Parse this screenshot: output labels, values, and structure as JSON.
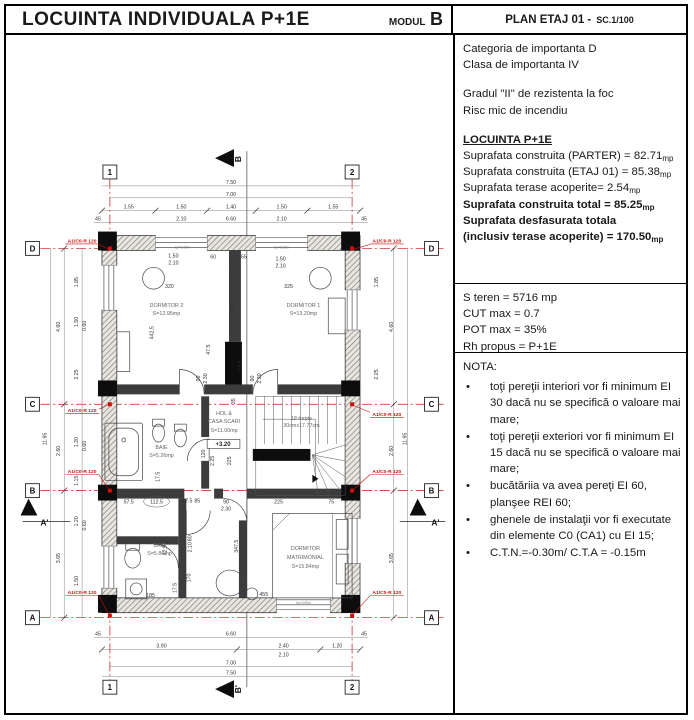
{
  "header": {
    "title": "LOCUINTA INDIVIDUALA P+1E",
    "modul_label": "MODUL",
    "modul_value": "B",
    "plan_label": "PLAN ETAJ 01 -",
    "scale": "SC.1/100"
  },
  "info_panel": {
    "importance": [
      "Categoria  de importanta  D",
      "Clasa de importanta IV"
    ],
    "fire": [
      "Gradul \"II\" de rezistenta la foc",
      "Risc mic de incendiu"
    ],
    "areas_title": "LOCUINTA P+1E",
    "areas": [
      {
        "text": "Suprafata construita (PARTER) = 82.71",
        "unit": "mp"
      },
      {
        "text": "Suprafata construita (ETAJ 01) = 85.38",
        "unit": "mp"
      },
      {
        "text": "Suprafata terase acoperite= 2.54",
        "unit": "mp"
      },
      {
        "text": "Suprafata construita total = 85.25",
        "unit": "mp"
      },
      {
        "text": "Suprafata desfasurata totala",
        "unit": ""
      },
      {
        "text": "(inclusiv terase acoperite) = 170.50",
        "unit": "mp"
      }
    ],
    "urbanism": [
      "S teren = 5716 mp",
      "CUT max = 0.7",
      "POT max = 35%",
      "Rh propus = P+1E"
    ],
    "nota_title": "NOTA:",
    "nota": [
      {
        "dot": "•",
        "text": "toţi pereţii interiori vor fi minimum EI 30 dacă nu se specifică o valoare mai mare;"
      },
      {
        "dot": "•",
        "text": "toţi pereţii exteriori vor fi minimum EI 15 dacă nu se specifică o valoare mai mare;"
      },
      {
        "dot": "•",
        "text": "bucătăriia va avea pereţi EI 60, planşee REI 60;"
      },
      {
        "dot": "•",
        "text": "ghenele de instalaţii vor fi executate din elemente C0 (CA1) cu EI 15;"
      },
      {
        "dot": "•",
        "text": "C.T.N.=-0.30m/ C.T.A = -0.15m"
      }
    ]
  },
  "colors": {
    "accent_red": "#cc1111",
    "line_black": "#000000"
  },
  "plan": {
    "grid_bubbles": [
      {
        "t": "1",
        "x": 108,
        "y": 171
      },
      {
        "t": "2",
        "x": 352,
        "y": 171
      },
      {
        "t": "1",
        "x": 108,
        "y": 690
      },
      {
        "t": "2",
        "x": 352,
        "y": 690
      },
      {
        "t": "D",
        "x": 30,
        "y": 248
      },
      {
        "t": "C",
        "x": 30,
        "y": 405
      },
      {
        "t": "B",
        "x": 30,
        "y": 492
      },
      {
        "t": "A",
        "x": 30,
        "y": 620
      },
      {
        "t": "D",
        "x": 432,
        "y": 248
      },
      {
        "t": "C",
        "x": 432,
        "y": 405
      },
      {
        "t": "B",
        "x": 432,
        "y": 492
      },
      {
        "t": "A",
        "x": 432,
        "y": 620
      }
    ],
    "texts": [
      {
        "t": "7.50",
        "x": 230,
        "y": 183
      },
      {
        "t": "7.00",
        "x": 230,
        "y": 195
      },
      {
        "t": "1.55",
        "x": 127,
        "y": 208
      },
      {
        "t": "1.50",
        "x": 180,
        "y": 208
      },
      {
        "t": "1.40",
        "x": 230,
        "y": 208
      },
      {
        "t": "1.50",
        "x": 281,
        "y": 208
      },
      {
        "t": "1.55",
        "x": 333,
        "y": 208
      },
      {
        "t": "45",
        "x": 96,
        "y": 220
      },
      {
        "t": "2.10",
        "x": 180,
        "y": 220
      },
      {
        "t": "6.60",
        "x": 230,
        "y": 220
      },
      {
        "t": "2.10",
        "x": 281,
        "y": 220
      },
      {
        "t": "45",
        "x": 364,
        "y": 220
      },
      {
        "t": "45",
        "x": 96,
        "y": 638
      },
      {
        "t": "6.60",
        "x": 230,
        "y": 638
      },
      {
        "t": "45",
        "x": 364,
        "y": 638
      },
      {
        "t": "3.90",
        "x": 160,
        "y": 650
      },
      {
        "t": "2.40",
        "x": 283,
        "y": 650
      },
      {
        "t": "1.20",
        "x": 337,
        "y": 650
      },
      {
        "t": "2.10",
        "x": 283,
        "y": 659
      },
      {
        "t": "7.00",
        "x": 230,
        "y": 667
      },
      {
        "t": "7.50",
        "x": 230,
        "y": 677
      },
      {
        "t": "11.65",
        "x": 44,
        "y": 440,
        "r": -90
      },
      {
        "t": "4.60",
        "x": 58,
        "y": 327,
        "r": -90
      },
      {
        "t": "2.60",
        "x": 58,
        "y": 452,
        "r": -90
      },
      {
        "t": "3.65",
        "x": 58,
        "y": 560,
        "r": -90
      },
      {
        "t": "1.85",
        "x": 76,
        "y": 282,
        "r": -90
      },
      {
        "t": "1.50",
        "x": 76,
        "y": 322,
        "r": -90
      },
      {
        "t": "0.60",
        "x": 84,
        "y": 326,
        "r": -90
      },
      {
        "t": "2.25",
        "x": 76,
        "y": 375,
        "r": -90
      },
      {
        "t": "1.20",
        "x": 76,
        "y": 443,
        "r": -90
      },
      {
        "t": "0.60",
        "x": 84,
        "y": 447,
        "r": -90
      },
      {
        "t": "1.15",
        "x": 76,
        "y": 482,
        "r": -90
      },
      {
        "t": "1.20",
        "x": 76,
        "y": 523,
        "r": -90
      },
      {
        "t": "0.60",
        "x": 84,
        "y": 527,
        "r": -90
      },
      {
        "t": "1.50",
        "x": 76,
        "y": 583,
        "r": -90
      },
      {
        "t": "4.60",
        "x": 393,
        "y": 327,
        "r": -90
      },
      {
        "t": "11.65",
        "x": 407,
        "y": 440,
        "r": -90
      },
      {
        "t": "1.85",
        "x": 378,
        "y": 282,
        "r": -90
      },
      {
        "t": "2.25",
        "x": 378,
        "y": 375,
        "r": -90
      },
      {
        "t": "2.60",
        "x": 393,
        "y": 452,
        "r": -90
      },
      {
        "t": "3.65",
        "x": 393,
        "y": 560,
        "r": -90
      },
      {
        "t": "1.50",
        "x": 172,
        "y": 257
      },
      {
        "t": "2.10",
        "x": 172,
        "y": 264
      },
      {
        "t": "60",
        "x": 212,
        "y": 258
      },
      {
        "t": "65",
        "x": 243,
        "y": 258
      },
      {
        "t": "1.50",
        "x": 280,
        "y": 260
      },
      {
        "t": "2.10",
        "x": 280,
        "y": 267
      },
      {
        "t": "15",
        "x": 233,
        "y": 272,
        "r": -90
      },
      {
        "t": "320",
        "x": 168,
        "y": 288
      },
      {
        "t": "325",
        "x": 288,
        "y": 288
      },
      {
        "t": "300",
        "x": 233,
        "y": 308,
        "r": -90
      },
      {
        "t": "442.5",
        "x": 152,
        "y": 333,
        "r": -90
      },
      {
        "t": "47.5",
        "x": 209,
        "y": 350,
        "r": -90
      },
      {
        "t": "17.5",
        "x": 241,
        "y": 366,
        "r": -90
      },
      {
        "t": "90",
        "x": 199,
        "y": 379,
        "r": -90
      },
      {
        "t": "2.30",
        "x": 206,
        "y": 379,
        "r": -90
      },
      {
        "t": "90",
        "x": 253,
        "y": 379,
        "r": -90
      },
      {
        "t": "2.30",
        "x": 260,
        "y": 379,
        "r": -90
      },
      {
        "t": "35",
        "x": 234,
        "y": 402,
        "r": -90
      },
      {
        "t": "120",
        "x": 204,
        "y": 455,
        "r": -90
      },
      {
        "t": "2.25",
        "x": 213,
        "y": 462,
        "r": -90
      },
      {
        "t": "225",
        "x": 230,
        "y": 462,
        "r": -90
      },
      {
        "t": "17.5",
        "x": 158,
        "y": 478,
        "r": -90
      },
      {
        "t": "57.5",
        "x": 127,
        "y": 505
      },
      {
        "t": "112.5",
        "x": 155,
        "y": 505
      },
      {
        "t": "17.5",
        "x": 186,
        "y": 504
      },
      {
        "t": "85",
        "x": 196,
        "y": 504
      },
      {
        "t": "90",
        "x": 225,
        "y": 505
      },
      {
        "t": "2.30",
        "x": 225,
        "y": 512
      },
      {
        "t": "225",
        "x": 278,
        "y": 505
      },
      {
        "t": "75",
        "x": 331,
        "y": 505
      },
      {
        "t": "80",
        "x": 190,
        "y": 540,
        "r": -90
      },
      {
        "t": "2.10",
        "x": 190,
        "y": 549,
        "r": -90
      },
      {
        "t": "347.5",
        "x": 237,
        "y": 548,
        "r": -90
      },
      {
        "t": "42.5",
        "x": 165,
        "y": 552,
        "r": -90
      },
      {
        "t": "170",
        "x": 189,
        "y": 580,
        "r": -90
      },
      {
        "t": "455",
        "x": 263,
        "y": 598
      },
      {
        "t": "185",
        "x": 149,
        "y": 599
      },
      {
        "t": "17.5",
        "x": 175,
        "y": 590,
        "r": -90
      },
      {
        "t": "DORMITOR 2",
        "x": 165,
        "y": 307,
        "cls": "room"
      },
      {
        "t": "S=12.95mp",
        "x": 165,
        "y": 315,
        "cls": "room"
      },
      {
        "t": "DORMITOR 1",
        "x": 303,
        "y": 307,
        "cls": "room"
      },
      {
        "t": "S=13.20mp",
        "x": 303,
        "y": 315,
        "cls": "room"
      },
      {
        "t": "HOL &",
        "x": 223,
        "y": 416,
        "cls": "room"
      },
      {
        "t": "CASA SCARI",
        "x": 223,
        "y": 424,
        "cls": "room"
      },
      {
        "t": "S=11.00mp",
        "x": 223,
        "y": 433,
        "cls": "room"
      },
      {
        "t": "+3.20",
        "x": 222,
        "y": 447,
        "cls": "level"
      },
      {
        "t": "18 trepte",
        "x": 301,
        "y": 421,
        "cls": "room",
        "s": 4.5
      },
      {
        "t": "30cmx17.77cm",
        "x": 301,
        "y": 428,
        "cls": "room",
        "s": 4.5
      },
      {
        "t": "BAIE",
        "x": 160,
        "y": 450,
        "cls": "room"
      },
      {
        "t": "S=5.26mp",
        "x": 160,
        "y": 458,
        "cls": "room"
      },
      {
        "t": "BAIE",
        "x": 158,
        "y": 549,
        "cls": "room"
      },
      {
        "t": "S=5.86mp",
        "x": 158,
        "y": 557,
        "cls": "room"
      },
      {
        "t": "DORMITOR",
        "x": 305,
        "y": 552,
        "cls": "room"
      },
      {
        "t": "MATRIMONIAL",
        "x": 305,
        "y": 561,
        "cls": "room"
      },
      {
        "t": "S=15.84mp",
        "x": 305,
        "y": 570,
        "cls": "room"
      },
      {
        "t": "hp=0.90m",
        "x": 181,
        "y": 248,
        "cls": "tiny"
      },
      {
        "t": "hp=0.90m",
        "x": 281,
        "y": 248,
        "cls": "tiny"
      },
      {
        "t": "hp=0.90m",
        "x": 303,
        "y": 606,
        "cls": "tiny"
      },
      {
        "t": "A1/C0-R 120",
        "x": 80,
        "y": 242,
        "cls": "red"
      },
      {
        "t": "A1/C0-R 120",
        "x": 387,
        "y": 242,
        "cls": "red"
      },
      {
        "t": "A1/C0-R 120",
        "x": 80,
        "y": 413,
        "cls": "red"
      },
      {
        "t": "A1/C0-R 120",
        "x": 387,
        "y": 417,
        "cls": "red"
      },
      {
        "t": "A1/C0-R 120",
        "x": 80,
        "y": 474,
        "cls": "red"
      },
      {
        "t": "A1/C0-R 120",
        "x": 387,
        "y": 474,
        "cls": "red"
      },
      {
        "t": "A1/C0-R 120",
        "x": 80,
        "y": 596,
        "cls": "red"
      },
      {
        "t": "A1/C0-R 120",
        "x": 387,
        "y": 596,
        "cls": "red"
      },
      {
        "t": "B",
        "x": 240,
        "y": 158,
        "cls": "section",
        "r": -90
      },
      {
        "t": "B'",
        "x": 240,
        "y": 692,
        "cls": "section",
        "r": -90
      },
      {
        "t": "A'",
        "x": 42,
        "y": 527,
        "cls": "section"
      },
      {
        "t": "A'",
        "x": 436,
        "y": 527,
        "cls": "section"
      }
    ]
  }
}
